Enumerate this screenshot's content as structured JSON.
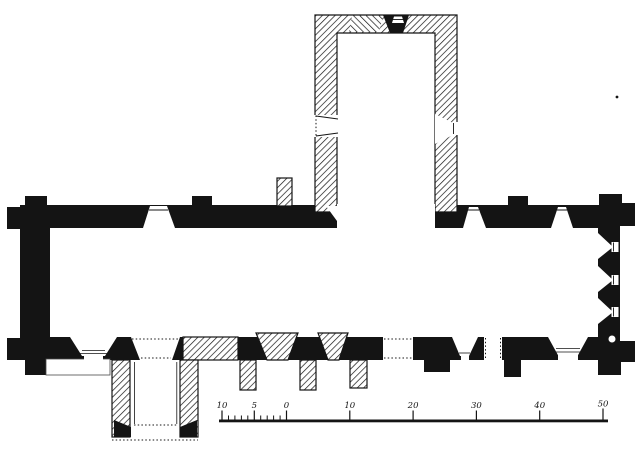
{
  "figure": {
    "kind": "engraved-church-floor-plan",
    "paper_color": "#ffffff",
    "ink_color": "#141414"
  },
  "scale_bar": {
    "labels": [
      "10",
      "5",
      "0",
      "10",
      "20",
      "30",
      "40",
      "50"
    ]
  }
}
